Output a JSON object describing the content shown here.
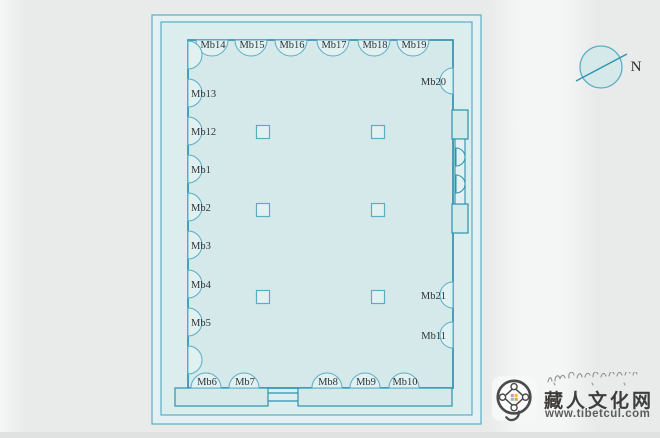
{
  "diagram": {
    "type": "floor-plan",
    "description": "Rectangular hall plan with perimeter half-round pilasters labeled Mb1-Mb21, six interior square pillars, bottom entrance porch and right-wall double door",
    "pillars_top": [
      {
        "id": "Mb14",
        "x": 212
      },
      {
        "id": "Mb15",
        "x": 251
      },
      {
        "id": "Mb16",
        "x": 291
      },
      {
        "id": "Mb17",
        "x": 333
      },
      {
        "id": "Mb18",
        "x": 374
      },
      {
        "id": "Mb19",
        "x": 413
      }
    ],
    "pillars_left": [
      {
        "id": "Mb13",
        "y": 93
      },
      {
        "id": "Mb12",
        "y": 131
      },
      {
        "id": "Mb1",
        "y": 169
      },
      {
        "id": "Mb2",
        "y": 207
      },
      {
        "id": "Mb3",
        "y": 245
      },
      {
        "id": "Mb4",
        "y": 284
      },
      {
        "id": "Mb5",
        "y": 322
      }
    ],
    "pillars_bottom": [
      {
        "id": "Mb6",
        "x": 206
      },
      {
        "id": "Mb7",
        "x": 244
      },
      {
        "id": "Mb8",
        "x": 327
      },
      {
        "id": "Mb9",
        "x": 365
      },
      {
        "id": "Mb10",
        "x": 404
      }
    ],
    "pillars_right": [
      {
        "id": "Mb20",
        "y": 81
      },
      {
        "id": "Mb21",
        "y": 295
      },
      {
        "id": "Mb11",
        "y": 335
      }
    ],
    "unlabeled_pillars_left_y": [
      55,
      360
    ],
    "interior_pillars": [
      {
        "x": 263,
        "y": 132
      },
      {
        "x": 378,
        "y": 132
      },
      {
        "x": 263,
        "y": 210
      },
      {
        "x": 378,
        "y": 210
      },
      {
        "x": 263,
        "y": 297
      },
      {
        "x": 378,
        "y": 297
      }
    ],
    "colors": {
      "thin_line": "#5aadc3",
      "wall_line": "#2d93ae",
      "paper_fill": "#e4f1f2",
      "inner_fill": "#dcedee",
      "room_fill": "#d5e9eb",
      "arc_fill": "#e1f1f2",
      "label": "#2f3336"
    }
  },
  "compass": {
    "label": "N"
  },
  "watermark": {
    "site_name": "藏人文化网",
    "site_url": "www.tibetcul.com"
  }
}
